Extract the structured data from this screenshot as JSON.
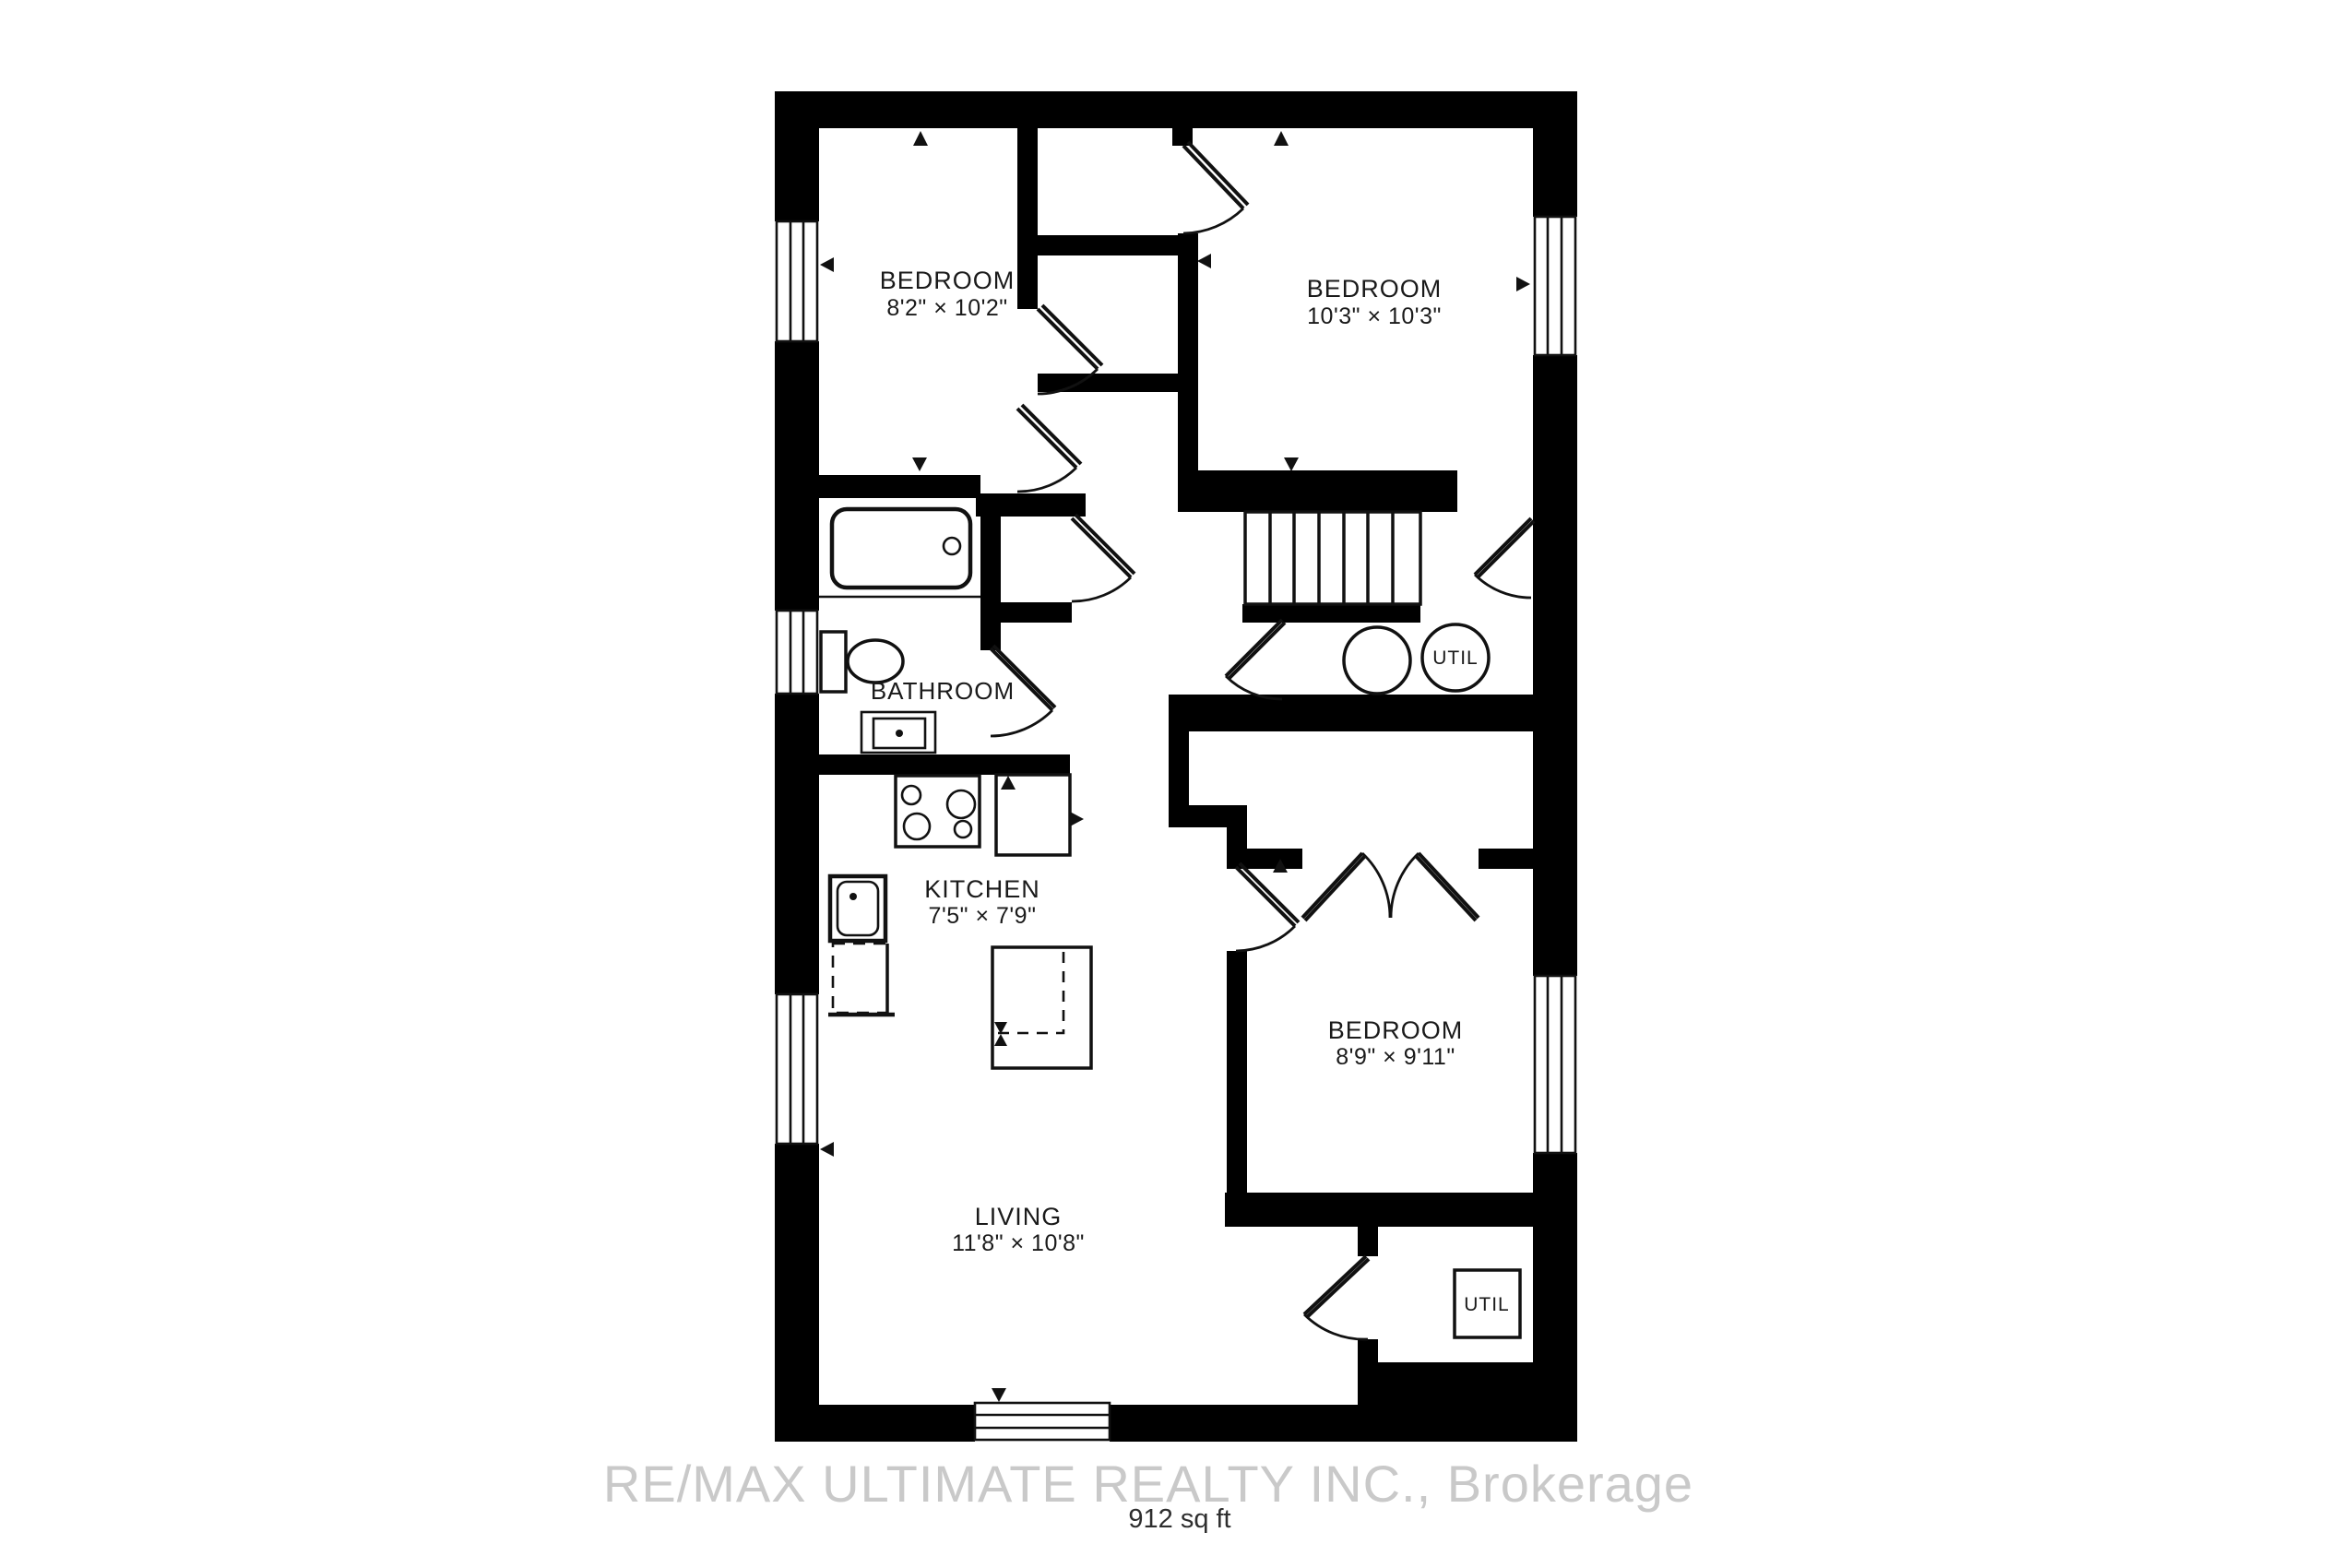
{
  "plan": {
    "watermark": "RE/MAX ULTIMATE REALTY INC., Brokerage",
    "area_label": "912 sq ft",
    "colors": {
      "wall": "#000000",
      "line": "#111111",
      "watermark": "#c9c9c9",
      "area_text": "#2e2e2e"
    },
    "rooms": [
      {
        "id": "bedroom-top-left",
        "name": "BEDROOM",
        "dims": "8'2\" × 10'2\""
      },
      {
        "id": "bedroom-top-right",
        "name": "BEDROOM",
        "dims": "10'3\" × 10'3\""
      },
      {
        "id": "bathroom",
        "name": "BATHROOM",
        "dims": ""
      },
      {
        "id": "kitchen",
        "name": "KITCHEN",
        "dims": "7'5\" × 7'9\""
      },
      {
        "id": "bedroom-right",
        "name": "BEDROOM",
        "dims": "8'9\" × 9'11\""
      },
      {
        "id": "living",
        "name": "LIVING",
        "dims": "11'8\" × 10'8\""
      },
      {
        "id": "utility-closet",
        "name": "UTIL",
        "dims": ""
      },
      {
        "id": "utility-room",
        "name": "UTIL",
        "dims": ""
      }
    ]
  }
}
